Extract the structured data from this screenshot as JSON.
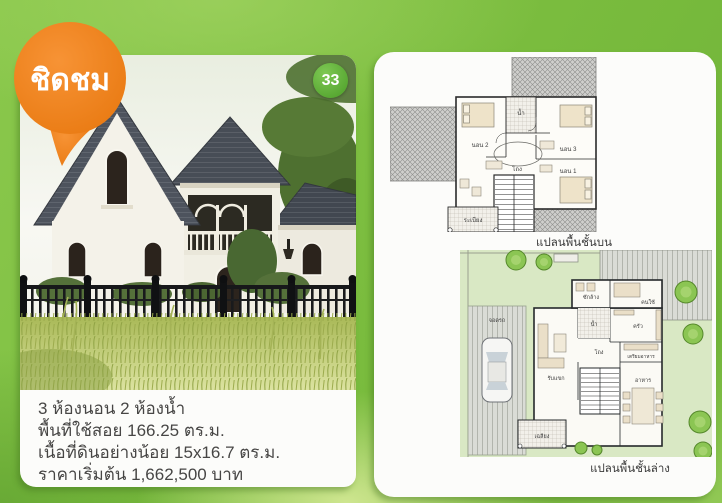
{
  "brochure": {
    "bubble_label": "ชิดชม",
    "badge_number": "33"
  },
  "left_card": {
    "specs": [
      "3 ห้องนอน 2 ห้องน้ำ",
      "พื้นที่ใช้สอย 166.25 ตร.ม.",
      "เนื้อที่ดินอย่างน้อย 15x16.7 ตร.ม.",
      "ราคาเริ่มต้น 1,662,500 บาท"
    ]
  },
  "plans": {
    "upper": {
      "caption": "แปลนพื้นชั้นบน",
      "rooms": {
        "bed2": "นอน 2",
        "bath": "น้ำ",
        "bed3": "นอน 3",
        "hall": "โถง",
        "bed1": "นอน 1",
        "balcony": "ระเบียง"
      }
    },
    "lower": {
      "caption": "แปลนพื้นชั้นล่าง",
      "rooms": {
        "laundry": "ซักล้าง",
        "maid": "คนใช้",
        "bath": "น้ำ",
        "kitchen": "ครัว",
        "living": "รับแขก",
        "hall": "โถง",
        "pantry": "เตรียมอาหาร",
        "dining": "อาหาร",
        "porch": "เฉลียง",
        "carport": "จอดรถ"
      }
    }
  },
  "colors": {
    "accent_orange": "#ee7f1f",
    "badge_green": "#5fae38",
    "background_green": "#7abc3e",
    "roof_slate": "#4a505a",
    "lawn_green": "#d9e8c4"
  }
}
